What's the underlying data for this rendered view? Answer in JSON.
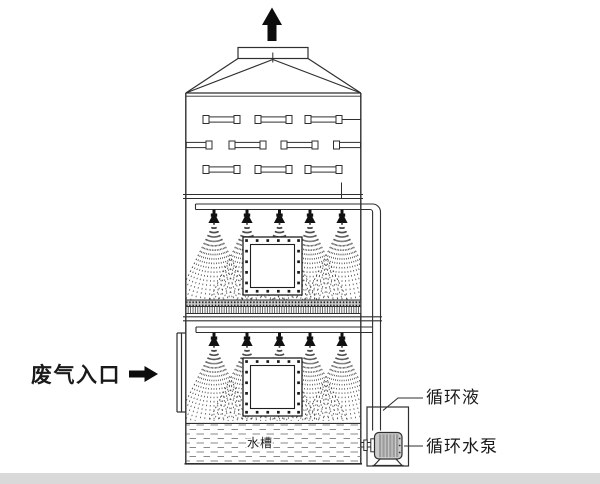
{
  "labels": {
    "waste_gas_inlet": "废气入口",
    "water_tank": "水槽",
    "circulating_liquid": "循环液",
    "circulating_pump": "循环水泵"
  },
  "colors": {
    "line": "#2f2f2f",
    "arrow_black": "#0d0d0d",
    "spray_dots": "#4a4a4a",
    "water_hatch": "#8a8a8a",
    "motor_fill": "#cccccc",
    "motor_stripe": "#9c9c9c",
    "bottom_strip": "#d9d9d9",
    "background": "#ffffff"
  }
}
